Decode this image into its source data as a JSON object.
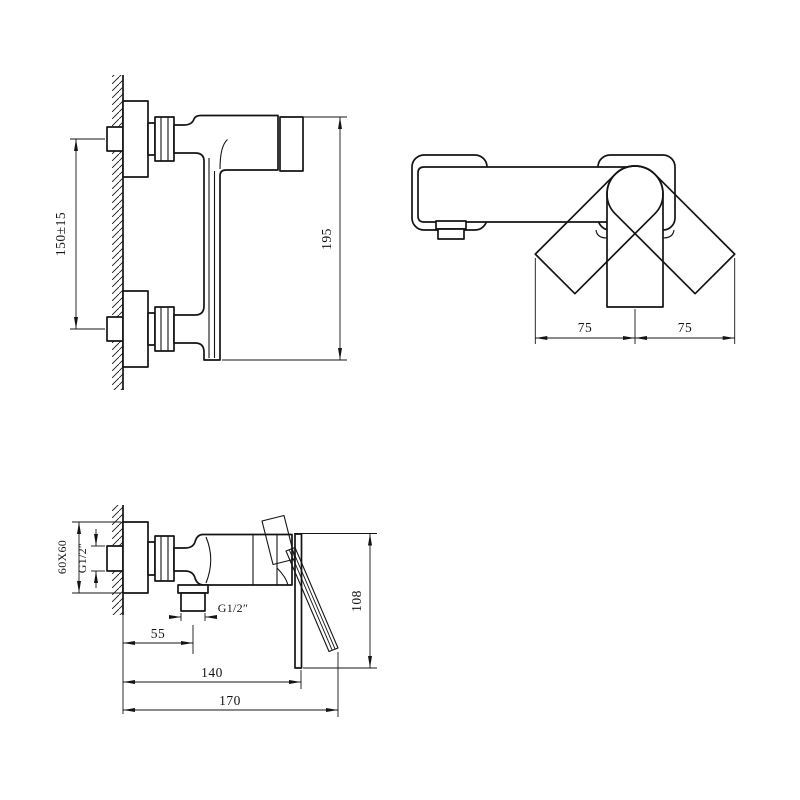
{
  "page": {
    "title": "faucet-technical-drawing",
    "background": "#ffffff",
    "line_color": "#141414"
  },
  "views": {
    "side": {
      "label": "side-view-wall-mounted",
      "dims": {
        "inlet_spacing": "150±15",
        "overall_height": "195"
      }
    },
    "front": {
      "label": "front-view-handle-swing",
      "dims": {
        "swing_left": "75",
        "swing_right": "75"
      }
    },
    "plan": {
      "label": "plan-view-open-handle",
      "dims": {
        "escutcheon": "60X60",
        "inlet_thread": "G1/2″",
        "outlet_thread": "G1/2″",
        "outlet_offset": "55",
        "body_depth": "140",
        "overall_depth": "170",
        "overall_height": "108"
      }
    }
  }
}
